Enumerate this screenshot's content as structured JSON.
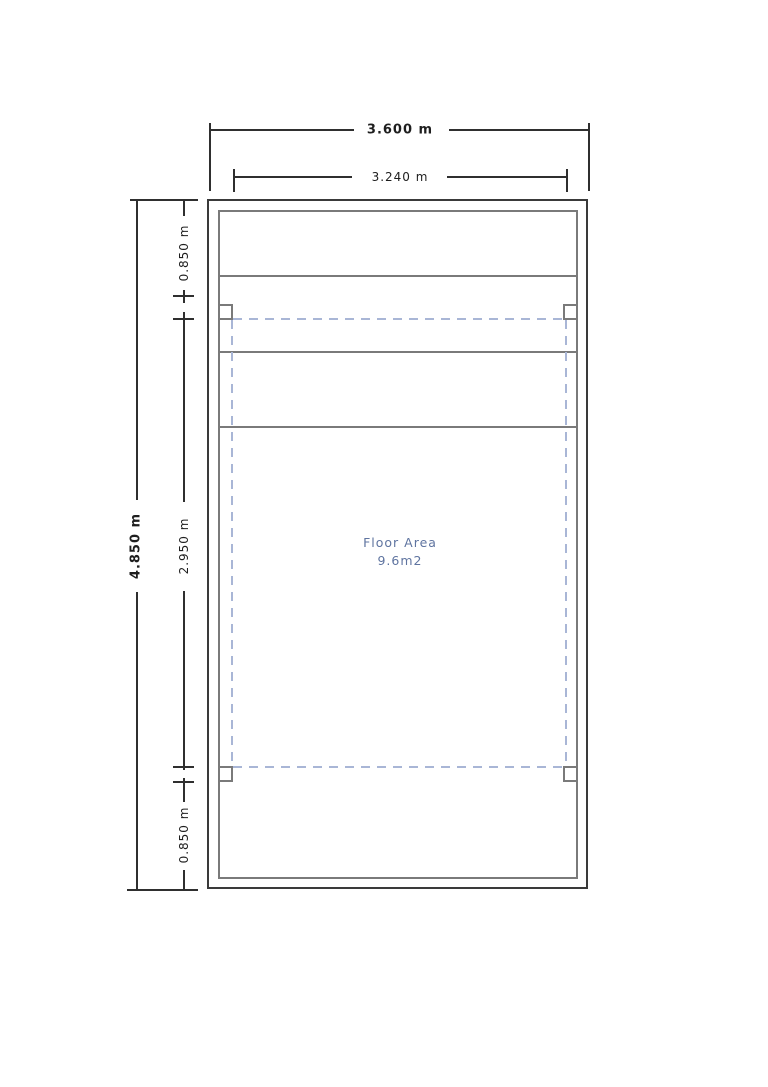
{
  "drawing": {
    "floor_area": {
      "line1": "Floor Area",
      "line2": "9.6m2"
    },
    "dims": {
      "outer_width": "3.600 m",
      "inner_width": "3.240 m",
      "outer_height": "4.850 m",
      "inner_height": "2.950 m",
      "top_offset": "0.850 m",
      "bottom_offset": "0.850 m"
    },
    "colors": {
      "wall_outer": "#3a3a3a",
      "wall_inner": "#7a7a7a",
      "dimension_line": "#2f2f2f",
      "dashed_boundary": "#a9b6d6",
      "floor_area_text": "#5f74a0"
    }
  }
}
